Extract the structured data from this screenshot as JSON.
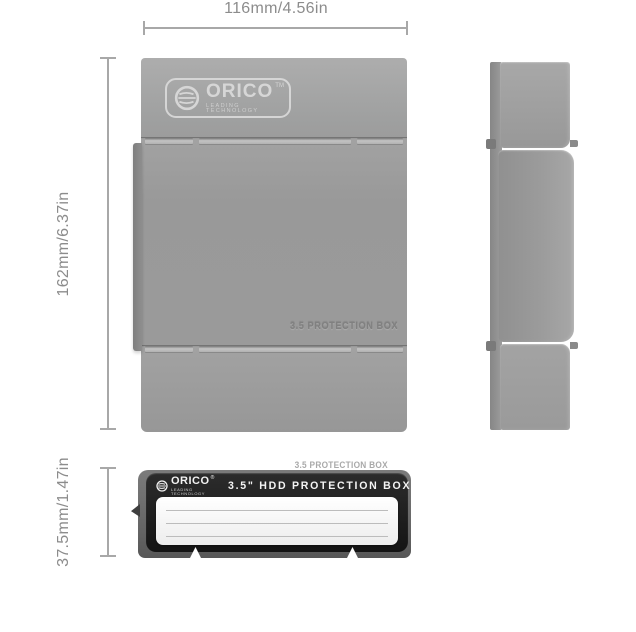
{
  "dimensions": {
    "width_label": "116mm/4.56in",
    "height_label": "162mm/6.37in",
    "depth_label": "37.5mm/1.47in"
  },
  "front_view": {
    "brand": "ORICO",
    "trademark": "TM",
    "tagline": "LEADING TECHNOLOGY",
    "embossed_text": "3.5 PROTECTION BOX"
  },
  "bottom_view": {
    "embossed_text": "3.5 PROTECTION BOX",
    "brand": "ORICO",
    "registered": "®",
    "tagline": "LEADING TECHNOLOGY",
    "title": "3.5\" HDD PROTECTION BOX"
  },
  "colors": {
    "body_gray": "#9b9b9b",
    "shell_dark_gray": "#6f6f6f",
    "face_black": "#1b1b1b",
    "label_white": "#f6f6f6",
    "dimension_gray": "#8c8c8c"
  }
}
